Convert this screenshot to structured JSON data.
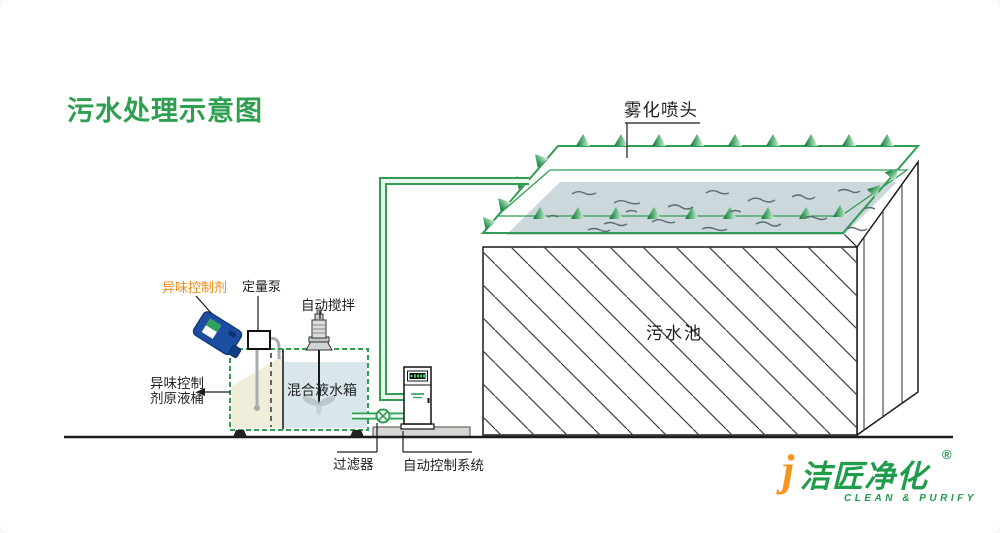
{
  "title": "污水处理示意图",
  "labels": {
    "spray_nozzle": "雾化喷头",
    "sewage_pool": "污水池",
    "odor_agent": "异味控制剂",
    "metering_pump": "定量泵",
    "auto_stir": "自动搅拌",
    "agent_barrel": "异味控制\n剂原液桶",
    "mixing_tank": "混合液水箱",
    "filter": "过滤器",
    "auto_control_system": "自动控制系统"
  },
  "logo": {
    "j_mark": "j",
    "name": "洁匠净化",
    "registered": "®",
    "tagline": "CLEAN & PURIFY"
  },
  "colors": {
    "diagram_green": "#2f9e52",
    "title_green": "#2e9e4f",
    "orange_label": "#ef8a17",
    "logo_green": "#1f9d4b",
    "logo_orange": "#f7941d",
    "pool_water": "#cdd8dc",
    "tank_water_blue": "#d9e6ec",
    "tank_cream": "#f0eeda",
    "jug_blue": "#1d4da1"
  }
}
